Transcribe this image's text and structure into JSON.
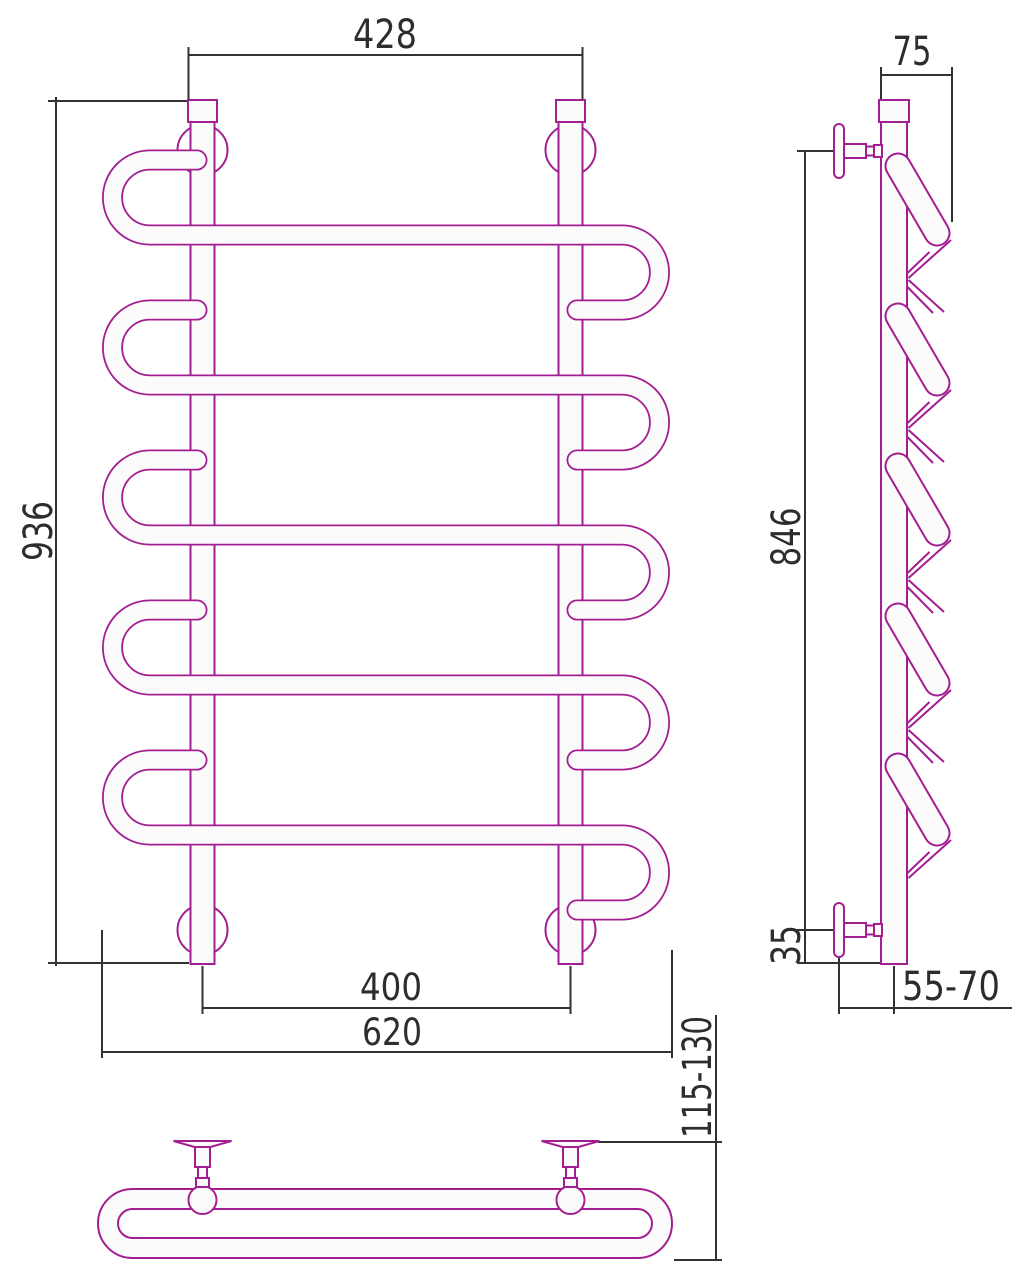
{
  "drawing": {
    "kind": "towel-rail-technical-drawing",
    "dims": {
      "front": {
        "top_width": "428",
        "height": "936",
        "rail_spacing": "400",
        "overall_width": "620"
      },
      "side": {
        "depth_top": "75",
        "mount_height": "846",
        "bottom_offset": "35",
        "wall_clearance": "55-70"
      },
      "bottom": {
        "depth_range": "115-130"
      }
    },
    "structure": {
      "coil_count": 5,
      "rail_count": 2,
      "wall_bracket_count": 4
    },
    "colors": {
      "product": "#A31E90",
      "dimension_line": "#323232",
      "text": "#2D2D2D",
      "tube_fill": "#FCFBFC",
      "background": "#FFFFFF"
    }
  }
}
